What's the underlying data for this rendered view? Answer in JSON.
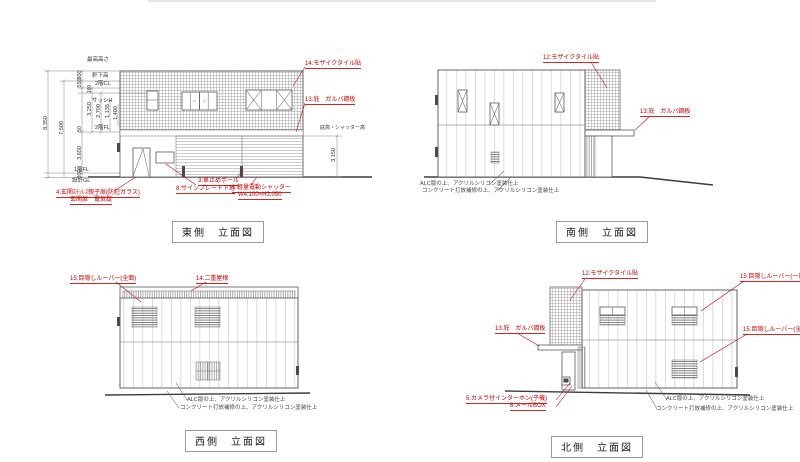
{
  "sheet": {
    "background": "#ffffff",
    "line_color": "#555555",
    "annotation_red": "#cc0000"
  },
  "finish_notes": {
    "line1": "ALC版の上、アクリルシリコン塗装仕上",
    "line2": "コンクリート打放補修の上、アクリルシリコン塗装仕上"
  },
  "east": {
    "title": "東側　立面図",
    "annotations": {
      "mosaic_tile": "14:モザイクタイル貼",
      "canopy": "13:庇　ガルバ鋼板",
      "entrance_door_1": "4:玄関ｽﾃﾝﾚｽ親子扉(防犯ガラス)",
      "entrance_door_2": "玄関扉　電気錠",
      "car_stop": "3:車止めポール",
      "sign_plate": "8:サインプレート下地",
      "shutter_1": "1:軽量電動シャッター",
      "shutter_2": "W4,100×H3,050"
    },
    "levels": {
      "max_height": "最高高さ",
      "eaves": "軒下高",
      "ceiling_2f": "2階CL",
      "sash": "サッシH",
      "floor_2f": "2階FL",
      "floor_1f": "1階FL",
      "design_gl": "設計GL",
      "canopy_shutter": "庇高・シャッター高"
    },
    "dimensions": {
      "total": "8,350",
      "upper": "7,500",
      "parapet": "800",
      "d550": "550",
      "d160": "160",
      "d3250": "3,250",
      "d2700": "2,700",
      "d1135": "1,135",
      "d1400": "1,400",
      "d50": "50",
      "d3650": "3,650",
      "d300": "300",
      "d3150": "3,150"
    }
  },
  "south": {
    "title": "南側　立面図",
    "annotations": {
      "mosaic_tile": "12:モザイクタイル貼",
      "canopy": "13:庇　ガルバ鋼板"
    }
  },
  "west": {
    "title": "西側　立面図",
    "annotations": {
      "louver_full": "15:目隠しルーバー(全面)",
      "double_roof": "14:二重屋根"
    }
  },
  "north": {
    "title": "北側　立面図",
    "annotations": {
      "mosaic_tile": "12:モザイクタイル貼",
      "louver_partial": "15:目隠しルーバー(一部)",
      "louver_full": "15:目隠しルーバー(全面)",
      "canopy": "13:庇　ガルバ鋼板",
      "intercom": "5:カメラ付インターホン(子機)",
      "mailbox": "6:メールBOX"
    }
  }
}
